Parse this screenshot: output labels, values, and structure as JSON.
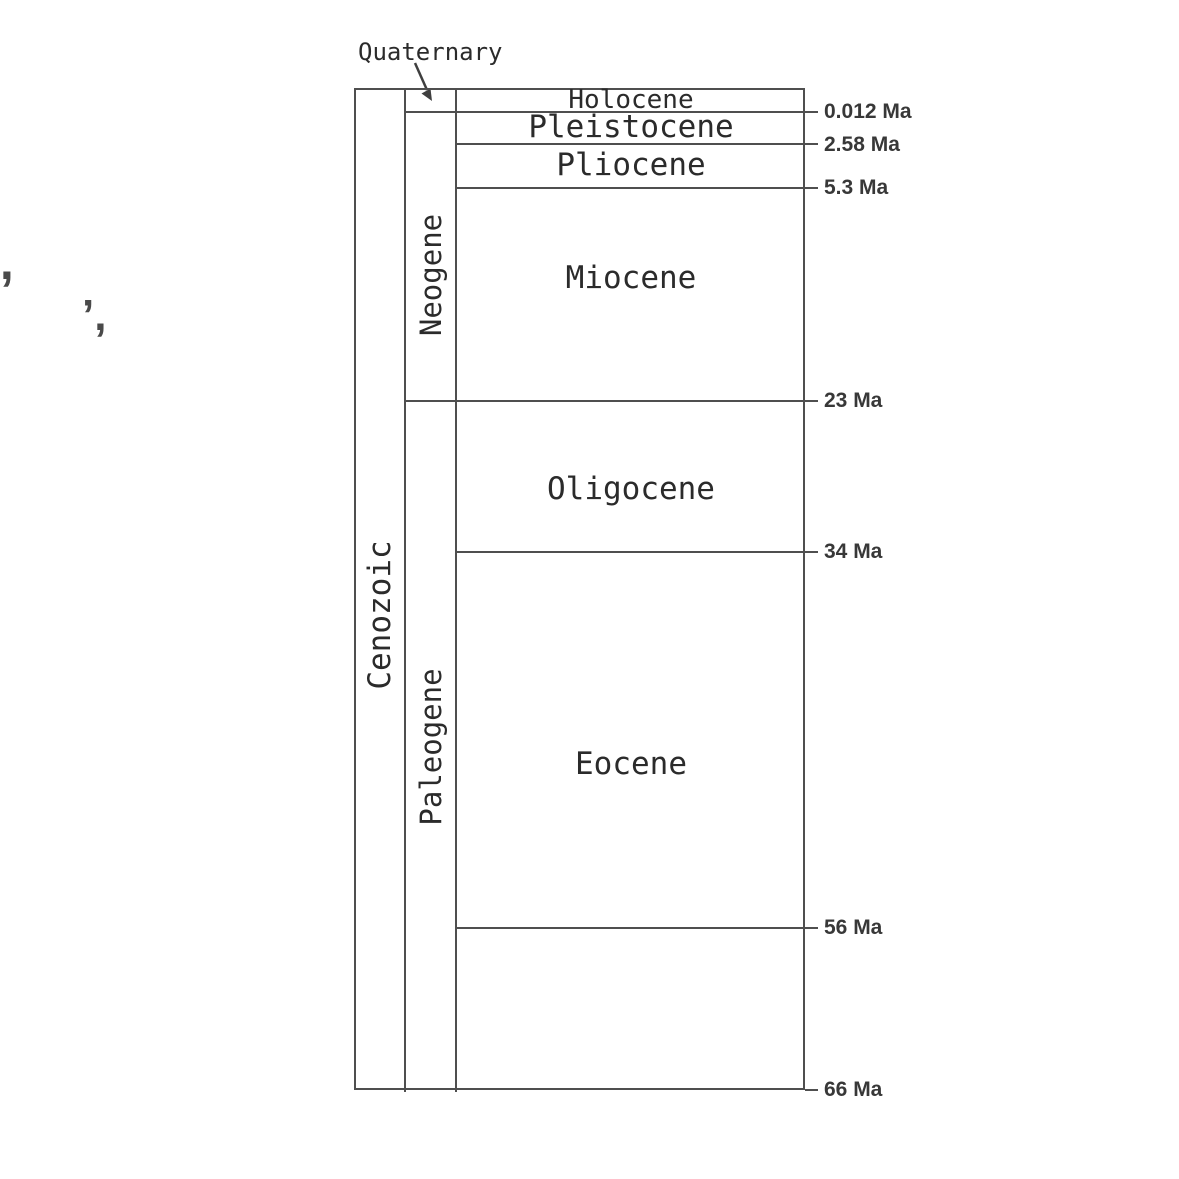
{
  "diagram": {
    "title_context": "Cenozoic geologic time scale",
    "era": {
      "label": "Cenozoic"
    },
    "periods": {
      "quaternary": "Quaternary",
      "neogene": "Neogene",
      "paleogene": "Paleogene"
    },
    "epochs": [
      "Holocene",
      "Pleistocene",
      "Pliocene",
      "Miocene",
      "Oligocene",
      "Eocene"
    ],
    "age_labels": [
      "0.012 Ma",
      "2.58 Ma",
      "5.3 Ma",
      "23 Ma",
      "34 Ma",
      "56 Ma",
      "66 Ma"
    ],
    "boundaries_ma": [
      0.012,
      2.58,
      5.3,
      23,
      34,
      56,
      66
    ],
    "colors": {
      "line": "#4f4f4f",
      "text": "#2b2b2b",
      "background": "#ffffff"
    }
  },
  "stray_marks": [
    "’,",
    "’,"
  ]
}
